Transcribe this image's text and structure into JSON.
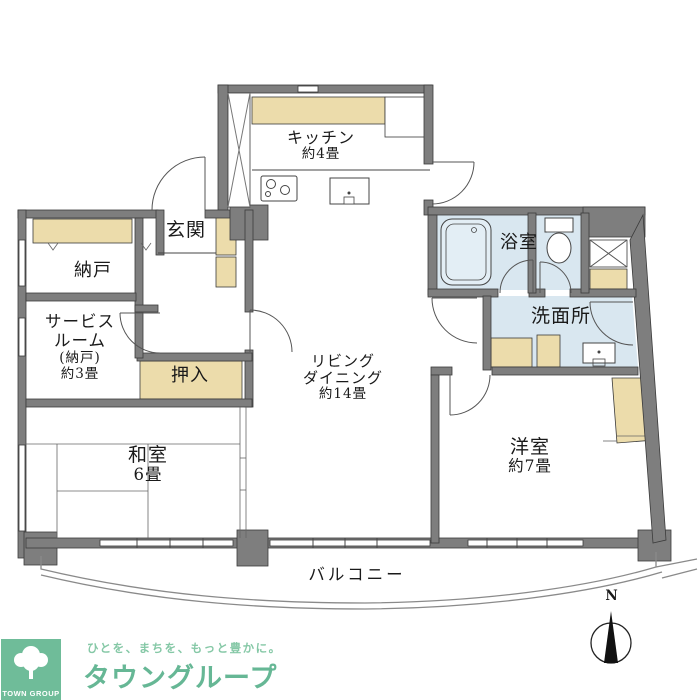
{
  "colors": {
    "wall": "#7e7e7e",
    "beige": "#ecdcab",
    "blue": "#d9e7f0",
    "logo_green": "#6fbc99",
    "brand_green": "#66b795",
    "tagline_green": "#85c8a6"
  },
  "rooms": {
    "kitchen": {
      "name": "キッチン",
      "size": "約4畳"
    },
    "entrance": {
      "name": "玄関"
    },
    "storage": {
      "name": "納戸"
    },
    "service_room": {
      "line1": "サービス",
      "line2": "ルーム",
      "line3": "(納戸)",
      "line4": "約3畳"
    },
    "closet": {
      "name": "押入"
    },
    "living_dining": {
      "line1": "リビング",
      "line2": "ダイニング",
      "line3": "約14畳"
    },
    "japanese_room": {
      "name": "和室",
      "size": "6畳"
    },
    "western_room": {
      "name": "洋室",
      "size": "約7畳"
    },
    "bathroom": {
      "name": "浴室"
    },
    "washroom": {
      "name": "洗面所"
    },
    "balcony": {
      "name": "バルコニー"
    }
  },
  "compass": {
    "north_label": "N"
  },
  "logo": {
    "square_text": "TOWN GROUP",
    "tagline": "ひとを、まちを、もっと豊かに。",
    "brand": "タウングループ"
  }
}
